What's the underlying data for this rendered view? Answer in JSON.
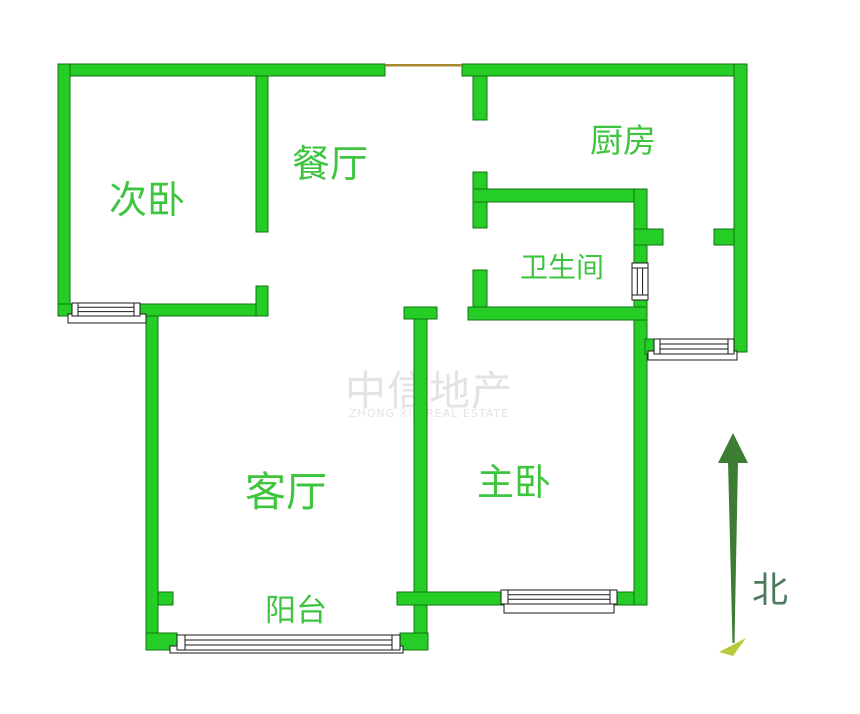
{
  "rooms": {
    "secondary_bedroom": {
      "label": "次卧"
    },
    "dining_room": {
      "label": "餐厅"
    },
    "kitchen": {
      "label": "厨房"
    },
    "bathroom": {
      "label": "卫生间"
    },
    "living_room": {
      "label": "客厅"
    },
    "master_bedroom": {
      "label": "主卧"
    },
    "balcony": {
      "label": "阳台"
    }
  },
  "compass": {
    "north_label": "北"
  },
  "watermark": {
    "text": "中信地产",
    "subtext": "ZHONG XIN REAL ESTATE"
  },
  "colors": {
    "wall_fill": "#26cd26",
    "wall_stroke": "#117511",
    "room_label": "#3fc43f",
    "window_stroke": "#1a1a1a",
    "entry_door_line": "#a8872f",
    "north_arrow": "#3c7d33",
    "north_arrow_tail": "#b6ca3b",
    "north_label": "#4e7a5c",
    "watermark": "#e3e3e3"
  }
}
